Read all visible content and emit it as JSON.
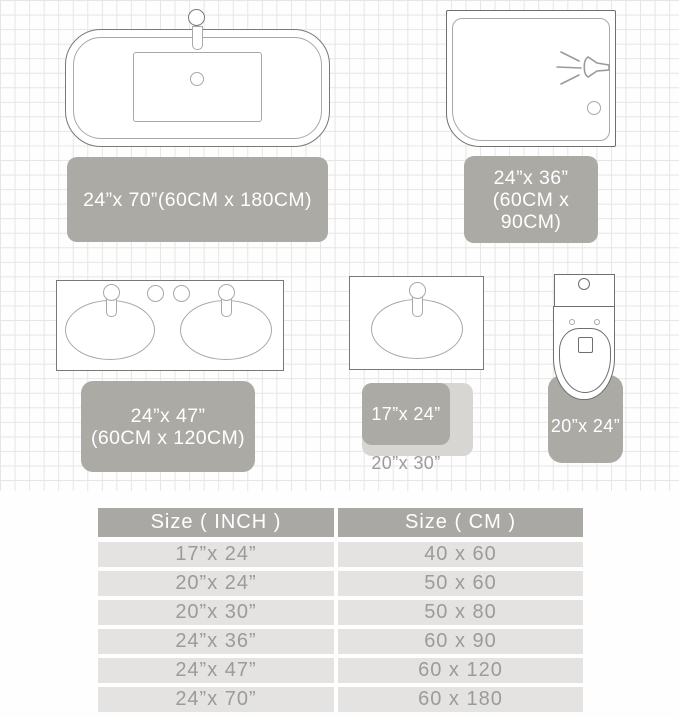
{
  "colors": {
    "rug_gray": "#abaaa5",
    "rug_light_gray": "#d7d6d3",
    "rug_text": "#ffffff",
    "table_header_bg": "#a9a8a4",
    "table_row_bg": "#e4e3e1",
    "table_row_text": "#9c9b99",
    "outline_dark": "#787876",
    "outline_light": "#a8a8a6",
    "grid_line": "#d9d9d7"
  },
  "diagram": {
    "bathtub": {
      "rug_label": "24”x 70”(60CM x 180CM)"
    },
    "shower": {
      "rug_label_line1": "24”x 36”",
      "rug_label_line2": "(60CM x 90CM)"
    },
    "vanity": {
      "rug_label_line1": "24”x 47”",
      "rug_label_line2": "(60CM x 120CM)"
    },
    "sink": {
      "small_rug_label": "17”x 24”",
      "large_rug_label": "20”x 30”"
    },
    "toilet": {
      "rug_label": "20”x 24”"
    }
  },
  "table": {
    "headers": [
      "Size ( INCH )",
      "Size ( CM )"
    ],
    "rows": [
      [
        "17”x 24”",
        "40 x 60"
      ],
      [
        "20”x 24”",
        "50 x 60"
      ],
      [
        "20”x 30”",
        "50 x 80"
      ],
      [
        "24”x 36”",
        "60 x 90"
      ],
      [
        "24”x 47”",
        "60 x 120"
      ],
      [
        "24”x 70”",
        "60 x 180"
      ]
    ]
  }
}
